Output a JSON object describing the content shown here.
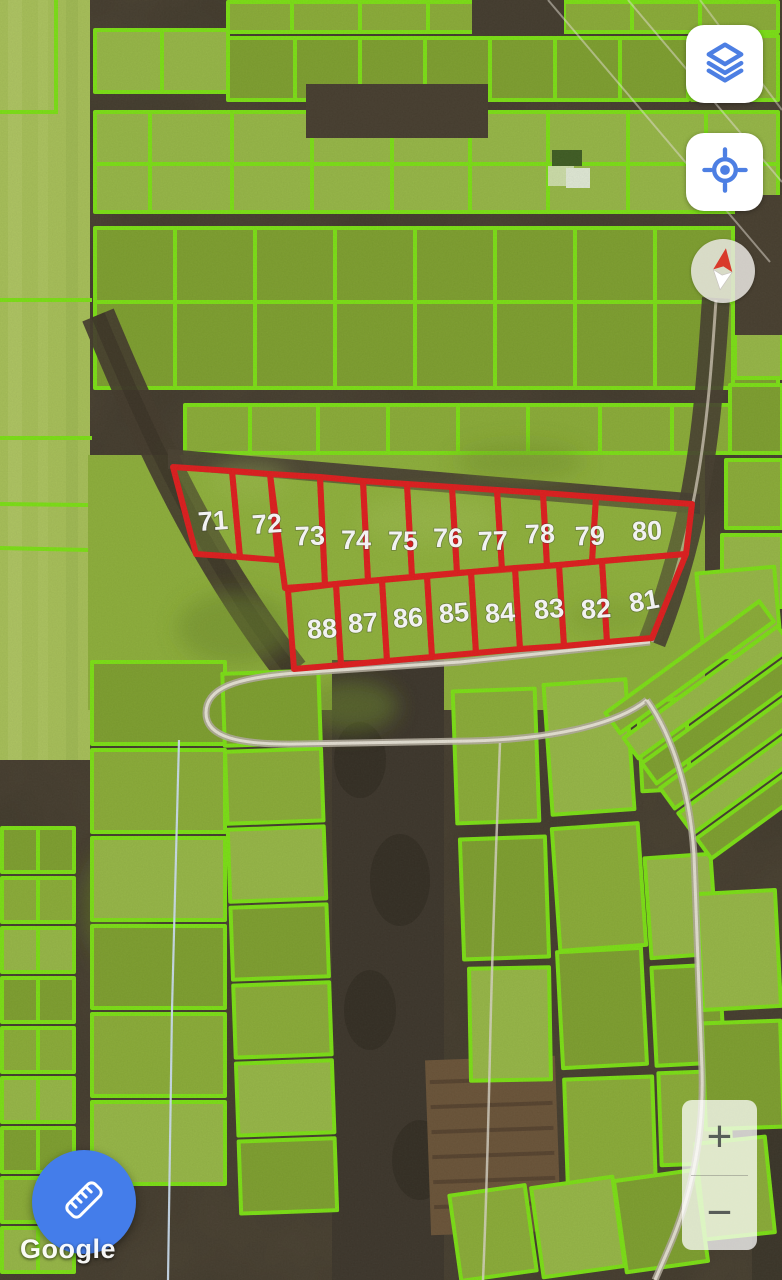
{
  "map": {
    "provider": "Google",
    "view_type": "satellite",
    "attribution_label": "Google",
    "green_outline_color": "#7de314",
    "red_overlay": {
      "stroke_color": "#e21d1d",
      "labels": [
        "71",
        "72",
        "73",
        "74",
        "75",
        "76",
        "77",
        "78",
        "79",
        "80",
        "88",
        "87",
        "86",
        "85",
        "84",
        "83",
        "82",
        "81"
      ]
    }
  },
  "controls": {
    "layers_button": {
      "icon": "layers-icon",
      "accent_color": "#4d7fe3"
    },
    "my_location_button": {
      "icon": "my-location-icon",
      "accent_color": "#4d7fe3"
    },
    "compass": {
      "icon": "compass-needle-icon",
      "north_color": "#d93a2b"
    },
    "measure_button": {
      "icon": "ruler-icon",
      "background_color": "#447dea"
    },
    "zoom": {
      "in_label": "+",
      "out_label": "−"
    }
  }
}
